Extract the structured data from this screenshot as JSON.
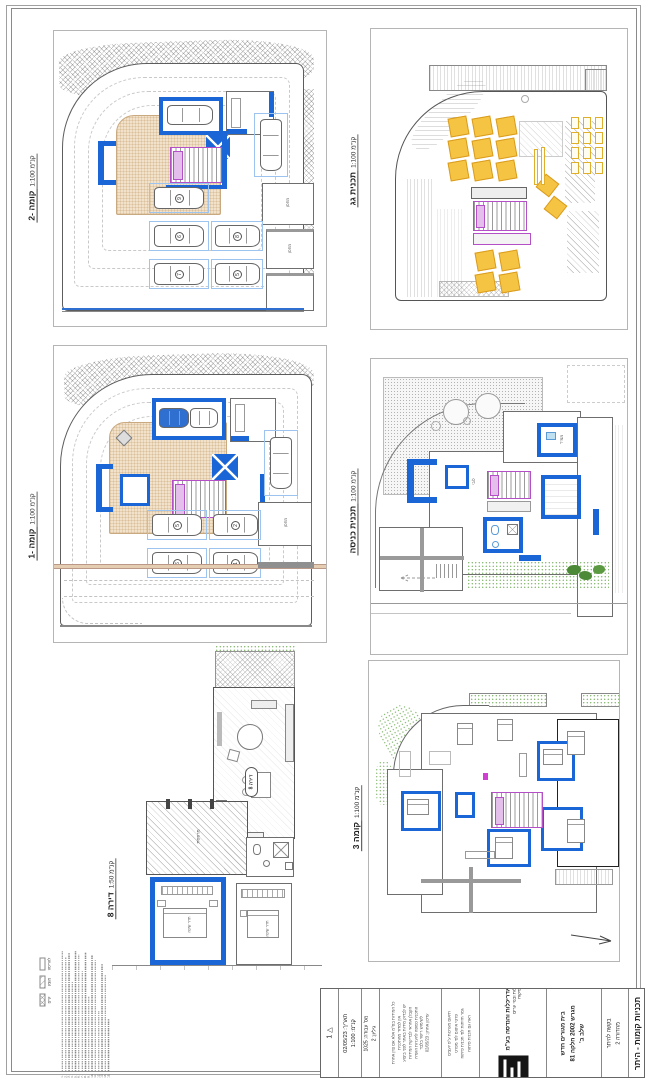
{
  "sheet": {
    "bg": "#ffffff"
  },
  "colors": {
    "wall_blue": "#1a66d6",
    "stall_blue": "#9cc4ee",
    "stair_purple": "#b44fc8",
    "deck_tan": "#e8d3b8",
    "panel_yellow": "#f6c443",
    "grass_green": "#6aa84f"
  },
  "plans": {
    "minus2": {
      "title": "קומה -2",
      "scale": "קנ\"מ 1:100",
      "stalls": [
        "9",
        "6",
        "8",
        "7",
        "5"
      ],
      "rooms": [
        "מחסן",
        "מחסן"
      ]
    },
    "roof": {
      "title": "תכנית גג",
      "scale": "קנ\"מ 1:100"
    },
    "minus1": {
      "title": "קומה -1",
      "scale": "קנ\"מ 1:100",
      "stalls": [
        "5",
        "2",
        "6",
        "1"
      ],
      "rooms": [
        "מחסן"
      ]
    },
    "entrance": {
      "title": "תכנית כניסה",
      "scale": "קנ\"מ 1:100",
      "rooms": [
        "לובי",
        "ממ\"ד"
      ]
    },
    "apt8": {
      "title": "דירה 8",
      "scale": "קנ\"מ 1:50",
      "tag": "דירה 8",
      "rooms": [
        "מרפסת",
        "חדר שינה",
        "חדר שינה"
      ]
    },
    "floor3": {
      "title": "קומה 3",
      "scale": "קנ\"מ 1:100"
    }
  },
  "legend": {
    "items": [
      "קיים",
      "מוצע",
      "להריסה"
    ]
  },
  "notes": {
    "items": [
      "1.",
      "2.",
      "3.",
      "4.",
      "5.",
      "6.",
      "7.",
      "8.",
      "9.",
      "10.",
      "11.",
      "12.",
      "13.",
      "14.",
      "15."
    ]
  },
  "titleblock": {
    "rev": "1",
    "date_line": "תאריך: 02/05/23",
    "scale_line": "קנ\"מ: 1:100",
    "job_line": "מס' עבודה: 1025",
    "sheet_line": "גיליון: 2",
    "small_a": [
      "כל המידות בס\"מ אלא אם צוין אחרת",
      "אין למדוד מהתכנית",
      "יש לבדוק מידות באתר לפני ביצוע",
      "הקבלן אחראי לבדיקת המידות",
      "התכנית כפופה להערות הועדה",
      "לשימוש רישוי בלבד",
      "עדכון אחרון: 02/05/23"
    ],
    "small_b": [
      "תיאום מערכות ע\"פ יועצים",
      "פרטי איטום לפי מפרט",
      "גמר חזיתות לפי תכנית פיתוח",
      "ראה גם תכנית פיתוח"
    ],
    "firm": "מ.ג אדריכלות והנדסה בע\"מ",
    "firm_sub": [
      "אדריכלות ובנוי ערים",
      "רישוי ופיקוח"
    ],
    "project": [
      "בית מגורים חדש",
      "מגרש 2002 חלקה 81",
      "שלב ב'"
    ],
    "doc": [
      "בקשה להיתר",
      "מהדורה 2"
    ],
    "sheet_title": "תכניות קומות - היתר"
  }
}
